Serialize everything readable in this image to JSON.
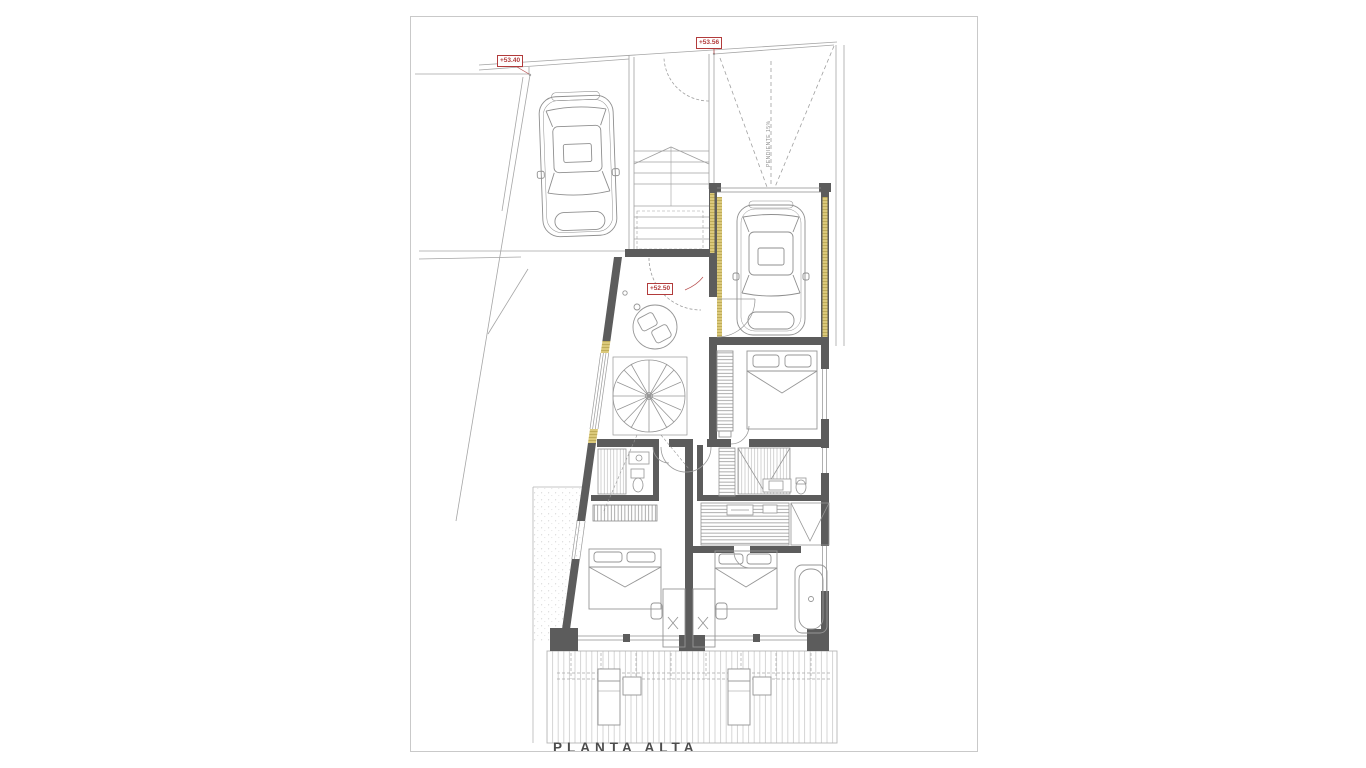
{
  "sheet": {
    "title": "PLANTA ALTA"
  },
  "markers": {
    "driveway_level": "+53.40",
    "entrance_level": "+53.56",
    "floor_level": "+52.50"
  },
  "ramp": {
    "label": "PENDIENTE 15%"
  },
  "colors": {
    "wall": "#5c5c5c",
    "line": "#a0a0a0",
    "accent_insulation": "#dbc97a",
    "marker_red": "#b23b3b",
    "paper": "#ffffff"
  }
}
